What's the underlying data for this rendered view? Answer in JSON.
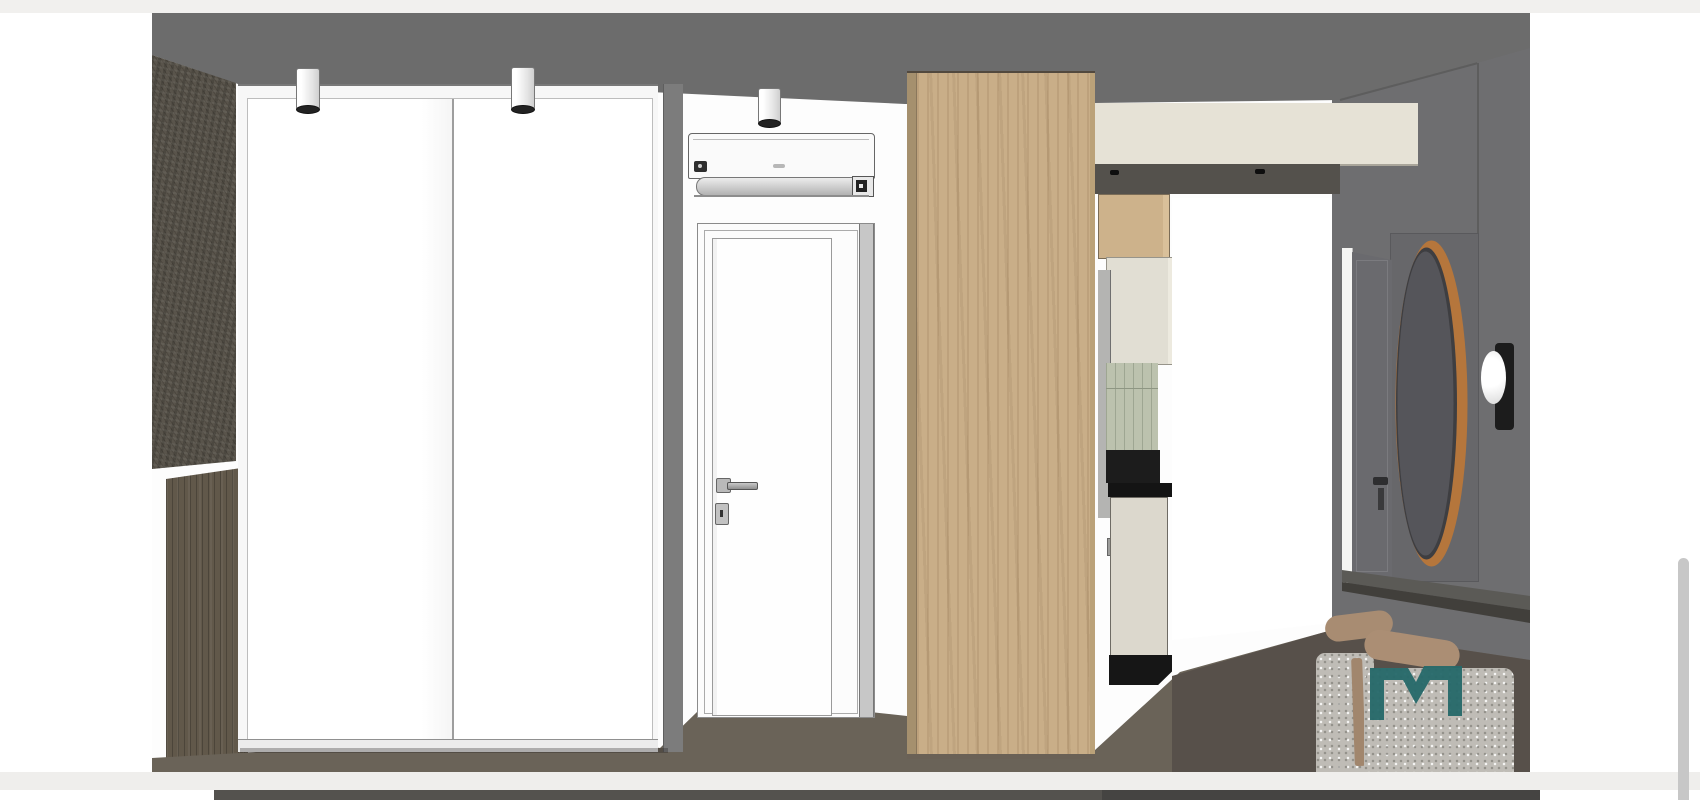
{
  "page": {
    "background": "#ffffff",
    "top_band": "#f1f0ee",
    "bottom_gap_band": "#efeeec",
    "scrollbar_thumb": "#c7c7c7",
    "next_image_strip_left": "#54524e",
    "next_image_strip_right": "#454442"
  },
  "render": {
    "watermark_label": "M",
    "palette": {
      "wall_white": "#fdfdfd",
      "ceiling": "#6c6c6c",
      "right_wall": "#6e6e70",
      "stone_wall": "#59544b",
      "dark_wood": "#61584a",
      "floor": "#6a6358",
      "floor_dark": "#57504a",
      "wardrobe_frame": "#f7f7f7",
      "wardrobe_door": "#ffffff",
      "wardrobe_side": "#7c7c7c",
      "door_white": "#fcfcfc",
      "ac_white": "#fafafa",
      "wood_panel": "#c9ae88",
      "bulkhead": "#e6e2d6",
      "soffit": "#54514c",
      "cabinet_wood": "#cdb28b",
      "cabinet_cream": "#e1ded3",
      "backsplash": "#bcc2ae",
      "counter_black": "#1c1c1c",
      "tall_unit": "#dcd8cd",
      "bright_wall": "#ffffff",
      "hall_door": "#6a6a6e",
      "dressing_panel": "#67676a",
      "mirror_wood": "#b5763c",
      "mirror_glass": "#55555a",
      "sconce_plate": "#1c1c1c",
      "sconce_light": "#f4f4f4",
      "desk_top": "#5b5a56",
      "desk_front": "#413f3b",
      "chair_tan": "#a88c72",
      "pouf": "#bfbcb6",
      "logo_teal": "#26696a"
    }
  }
}
